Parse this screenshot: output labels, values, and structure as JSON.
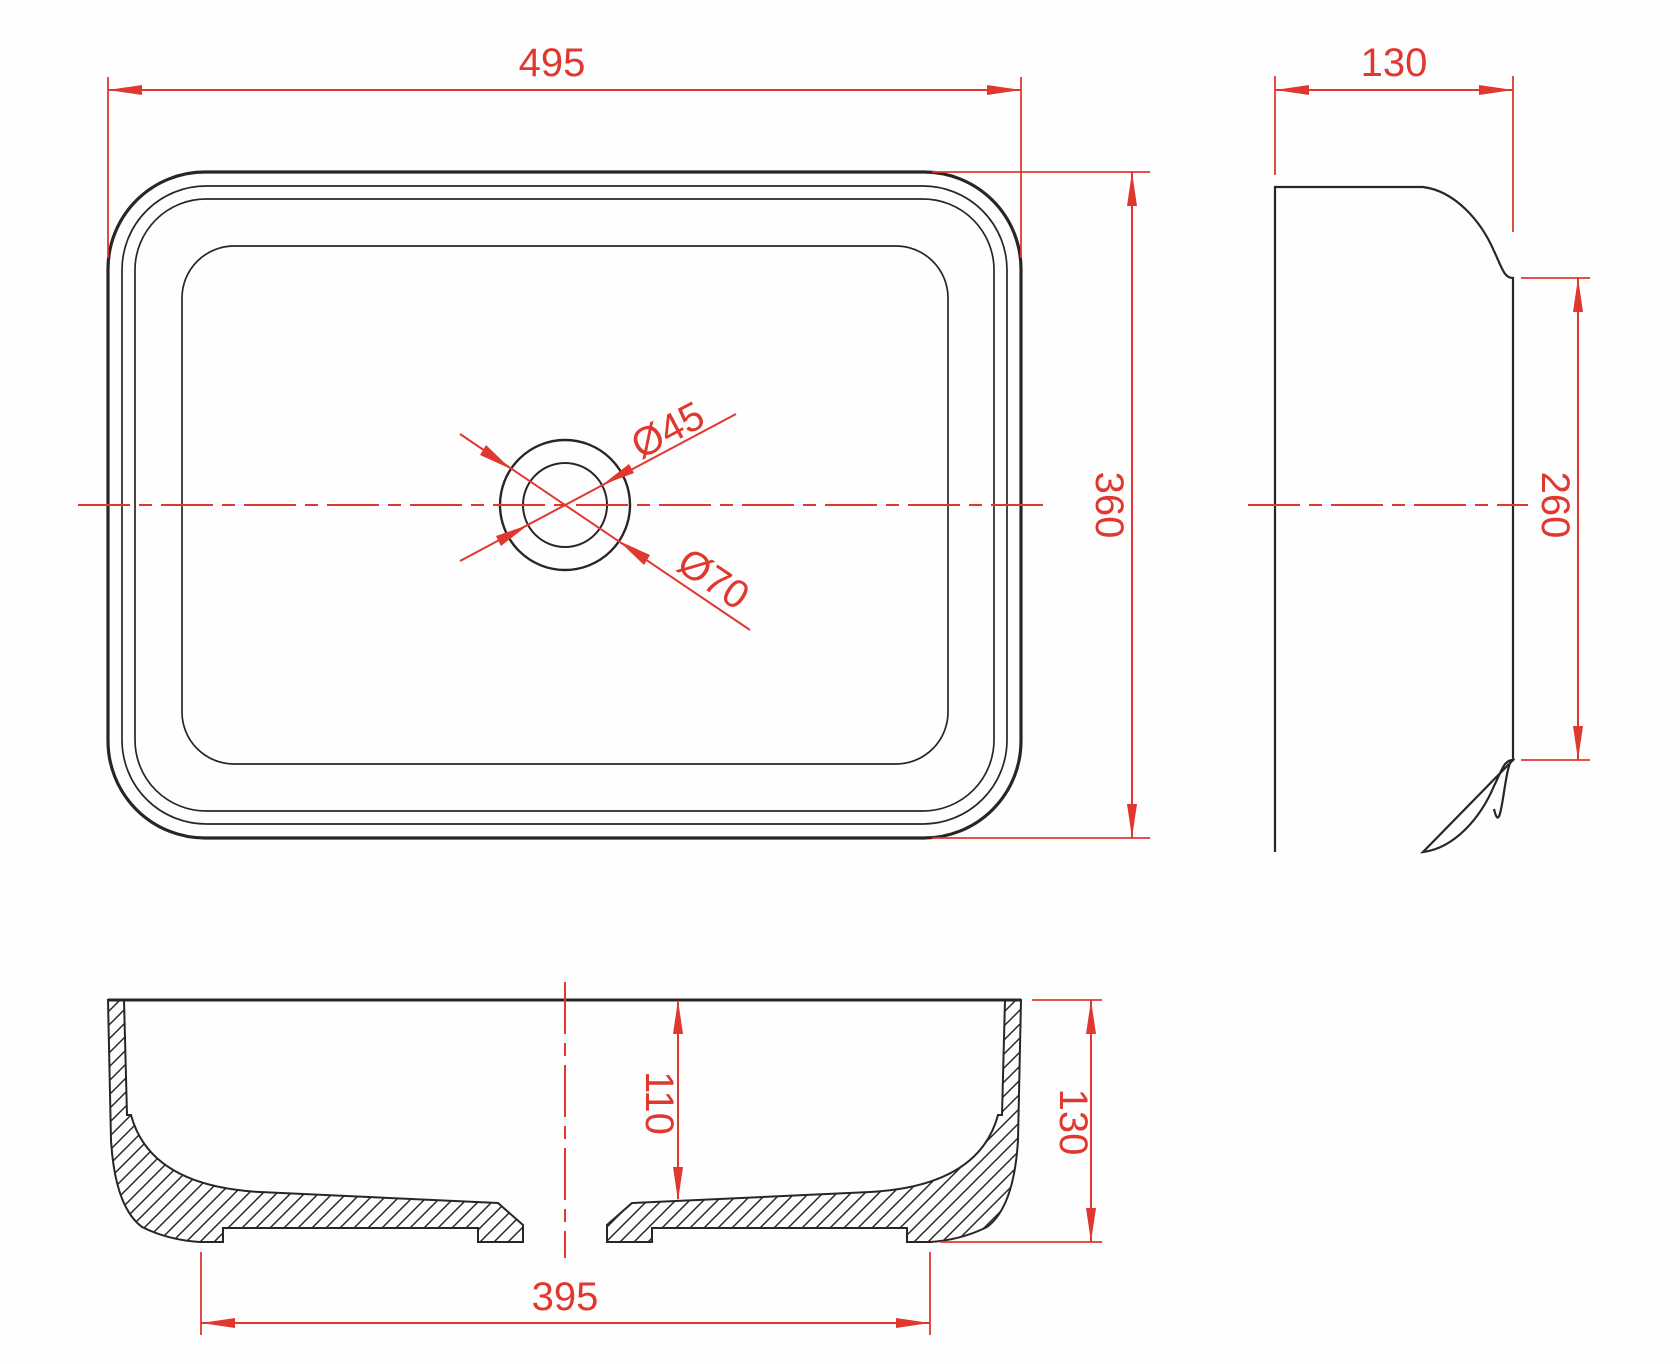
{
  "drawing": {
    "type": "technical-drawing",
    "subject": "rectangular countertop washbasin - three orthographic views with dimensions",
    "units": "mm",
    "accent_color": "#e0382e",
    "outline_color": "#2b2522",
    "background_color": "#fefefe",
    "views": {
      "plan": {
        "name": "top view",
        "dims": {
          "overall_width": "495",
          "overall_depth": "360",
          "drain_inner_diameter": "Ø45",
          "drain_outer_diameter": "Ø70"
        }
      },
      "side": {
        "name": "side view",
        "dims": {
          "overall_thickness": "130",
          "inner_face_height": "260"
        }
      },
      "section": {
        "name": "front section view",
        "dims": {
          "bowl_depth": "110",
          "overall_height": "130",
          "base_width": "395"
        }
      }
    }
  }
}
